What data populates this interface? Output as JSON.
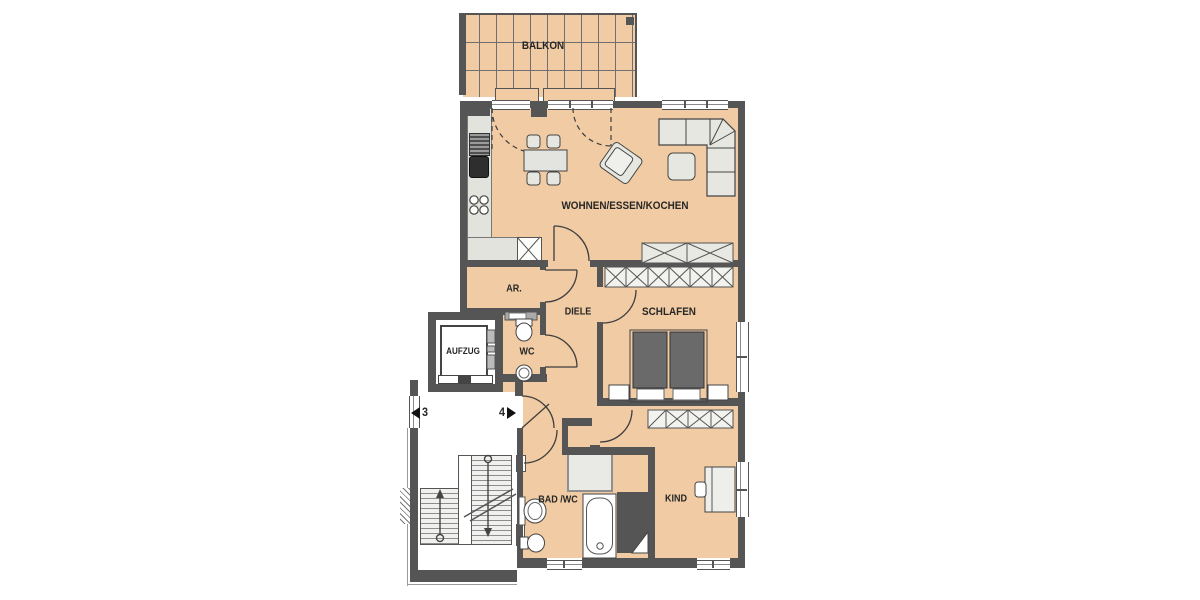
{
  "meta": {
    "type": "apartment-floor-plan"
  },
  "colors": {
    "floor": "#f0cba3",
    "wall": "#555555",
    "furniture_fill": "#e7e7e2",
    "dark_fixture": "#6a6a6a",
    "background": "#ffffff"
  },
  "rooms": {
    "balkon": {
      "label": "BALKON"
    },
    "wohnen": {
      "label": "WOHNEN/ESSEN/KOCHEN"
    },
    "ar": {
      "label": "AR."
    },
    "diele": {
      "label": "DIELE"
    },
    "wc": {
      "label": "WC"
    },
    "schlafen": {
      "label": "SCHLAFEN"
    },
    "aufzug": {
      "label": "AUFZUG"
    },
    "bad": {
      "label": "BAD /WC"
    },
    "kind": {
      "label": "KIND"
    }
  },
  "stairwell": {
    "left_unit": "3",
    "right_unit": "4"
  }
}
